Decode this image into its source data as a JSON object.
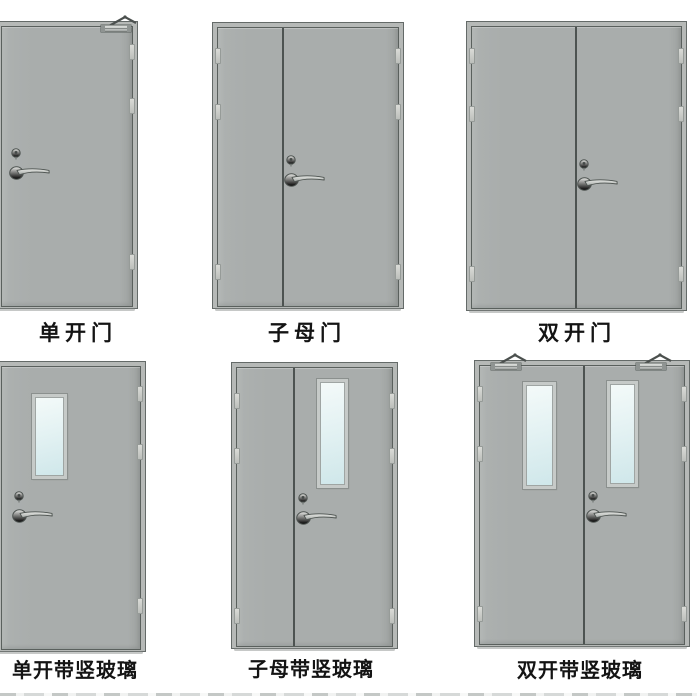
{
  "figure_title": "fire-door-types-catalog",
  "doors": [
    {
      "label": "单开门",
      "name": "single-door",
      "leaves": 1,
      "glass": false,
      "closer": true
    },
    {
      "label": "子母门",
      "name": "mother-child-door",
      "leaves": 2,
      "glass": false,
      "closer": false
    },
    {
      "label": "双开门",
      "name": "double-door",
      "leaves": 2,
      "glass": false,
      "closer": false
    },
    {
      "label": "单开带竖玻璃",
      "name": "single-door-vertical-glass",
      "leaves": 1,
      "glass": true,
      "closer": false
    },
    {
      "label": "子母带竖玻璃",
      "name": "mother-child-door-vertical-glass",
      "leaves": 2,
      "glass": true,
      "closer": false
    },
    {
      "label": "双开带竖玻璃",
      "name": "double-door-vertical-glass",
      "leaves": 2,
      "glass": true,
      "closer": true
    }
  ],
  "colors": {
    "page_bg": "#ffffff",
    "door_leaf": "#a9adac",
    "door_frame": "#b6b9b7",
    "frame_outline": "#646a68",
    "leaf_outline": "#5a605d",
    "divider": "#4d5351",
    "glass": "#cfe7ea",
    "glass_highlight": "#f4faf9",
    "hardware": "#c9cccb",
    "label_text": "#141414"
  }
}
